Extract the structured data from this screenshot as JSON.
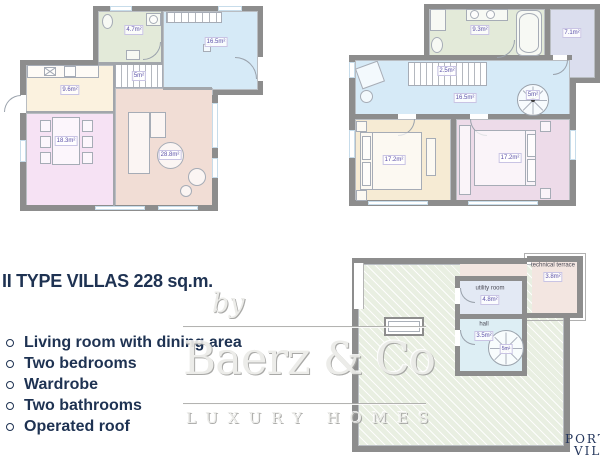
{
  "title": "II TYPE VILLAS 228 sq.m.",
  "features": [
    "Living room with dining area",
    "Two bedrooms",
    "Wardrobe",
    "Two bathrooms",
    "Operated roof"
  ],
  "watermark": {
    "prefix": "by",
    "brand": "Baerz & Co",
    "tagline": "LUXURY HOMES"
  },
  "corner_logo": {
    "line1": "PORT",
    "line2": "VIL"
  },
  "colors": {
    "heading_navy": "#1e3252",
    "wall_gray": "#8d8d8d",
    "area_label_purple": "#5b51a8",
    "bathroom_green": "#e3ead9",
    "hall_blue": "#d6eaf7",
    "kitchen_cream": "#fbf2df",
    "dining_pink": "#f6e2f4",
    "living_peach": "#f1ddd5",
    "wardrobe_lavender": "#dbdeee",
    "bedroom_cream": "#f6ebd4",
    "bedroom_pink": "#eddbe9",
    "roof_terrace_green": "#e9efe2",
    "technical_terrace_pink": "#f3e6e1",
    "utility_lavender": "#e3e9f4",
    "roof_hall_blue": "#ddeef4"
  },
  "plans": {
    "ground_floor": {
      "rooms": {
        "bathroom": {
          "area": "4.7m²"
        },
        "entrance_hall": {
          "area": "16.5m²"
        },
        "stairs": {
          "area": "5m²"
        },
        "kitchen": {
          "area": "9.6m²"
        },
        "dining": {
          "area": "18.3m²"
        },
        "living": {
          "area": "28.8m²"
        }
      }
    },
    "first_floor": {
      "rooms": {
        "bathroom": {
          "area": "9.3m²"
        },
        "wardrobe": {
          "area": "7.1m²"
        },
        "hall": {
          "area": "16.5m²"
        },
        "stairs": {
          "area": "2.5m²"
        },
        "spiral_stairs": {
          "area": "5m²"
        },
        "bedroom_left": {
          "area": "17.2m²"
        },
        "bedroom_right": {
          "area": "17.2m²"
        }
      }
    },
    "roof": {
      "rooms": {
        "technical_terrace": {
          "name": "technical terrace",
          "area": "3.8m²"
        },
        "utility_room": {
          "name": "utility room",
          "area": "4.8m²"
        },
        "hall": {
          "name": "hall",
          "area": "3.5m²"
        },
        "spiral_stairs": {
          "area": "5m²"
        }
      }
    }
  }
}
